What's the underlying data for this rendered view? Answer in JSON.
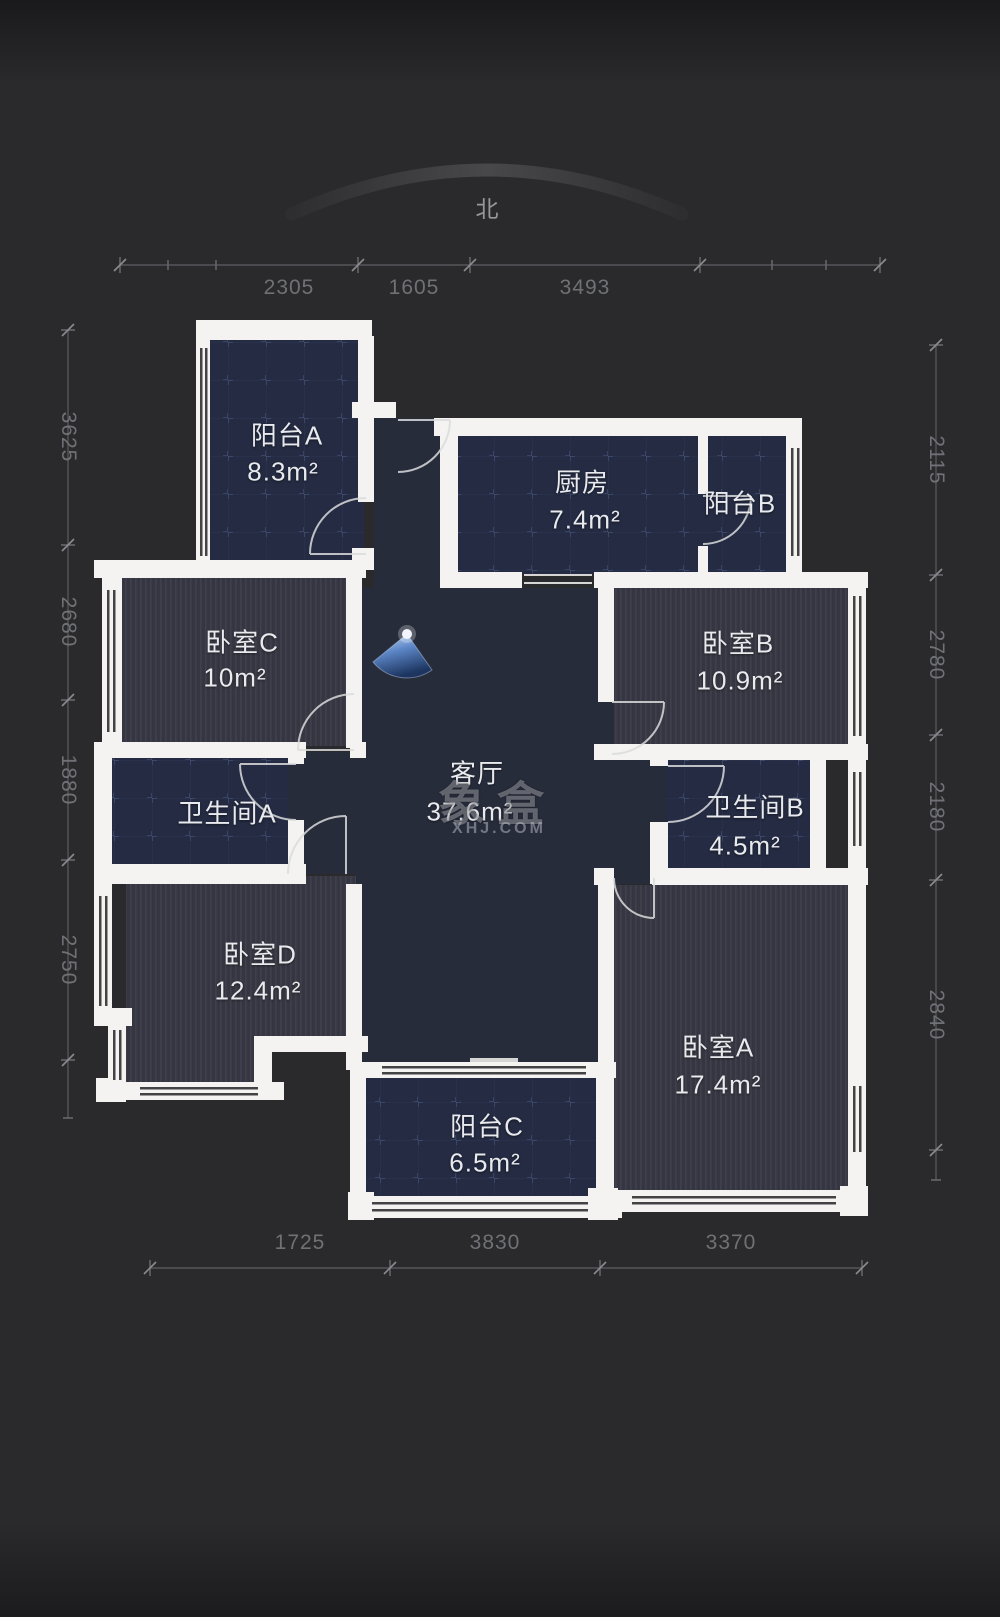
{
  "compass": {
    "north_label": "北"
  },
  "watermark": {
    "logo": "象盒",
    "domain": "XHJ.COM"
  },
  "dimensions": {
    "top": [
      "2305",
      "1605",
      "3493"
    ],
    "left": [
      "3625",
      "2680",
      "1880",
      "2750"
    ],
    "right": [
      "2115",
      "2780",
      "2180",
      "2840"
    ],
    "bottom": [
      "1725",
      "3830",
      "3370"
    ]
  },
  "rooms": {
    "balcony_a": {
      "name": "阳台A",
      "area": "8.3m²"
    },
    "kitchen": {
      "name": "厨房",
      "area": "7.4m²"
    },
    "balcony_b": {
      "name": "阳台B",
      "area": ""
    },
    "bedroom_c": {
      "name": "卧室C",
      "area": "10m²"
    },
    "bedroom_b": {
      "name": "卧室B",
      "area": "10.9m²"
    },
    "bath_a": {
      "name": "卫生间A",
      "area": ""
    },
    "living": {
      "name": "客厅",
      "area": "37.6m²"
    },
    "bath_b": {
      "name": "卫生间B",
      "area": "4.5m²"
    },
    "bedroom_d": {
      "name": "卧室D",
      "area": "12.4m²"
    },
    "bedroom_a": {
      "name": "卧室A",
      "area": "17.4m²"
    },
    "balcony_c": {
      "name": "阳台C",
      "area": "6.5m²"
    }
  },
  "icons": {
    "camera_cone": "view-direction-cone",
    "compass_arc": "north-arc"
  },
  "colors": {
    "wall": "#f4f3f1",
    "floor_tile": "#242b42",
    "floor_wood": "#353641",
    "floor_living": "#272c3b",
    "background": "#2a2a2c",
    "accent_cone": "#4a78c2",
    "text": "#e9eaee",
    "dim_text": "#707176"
  }
}
